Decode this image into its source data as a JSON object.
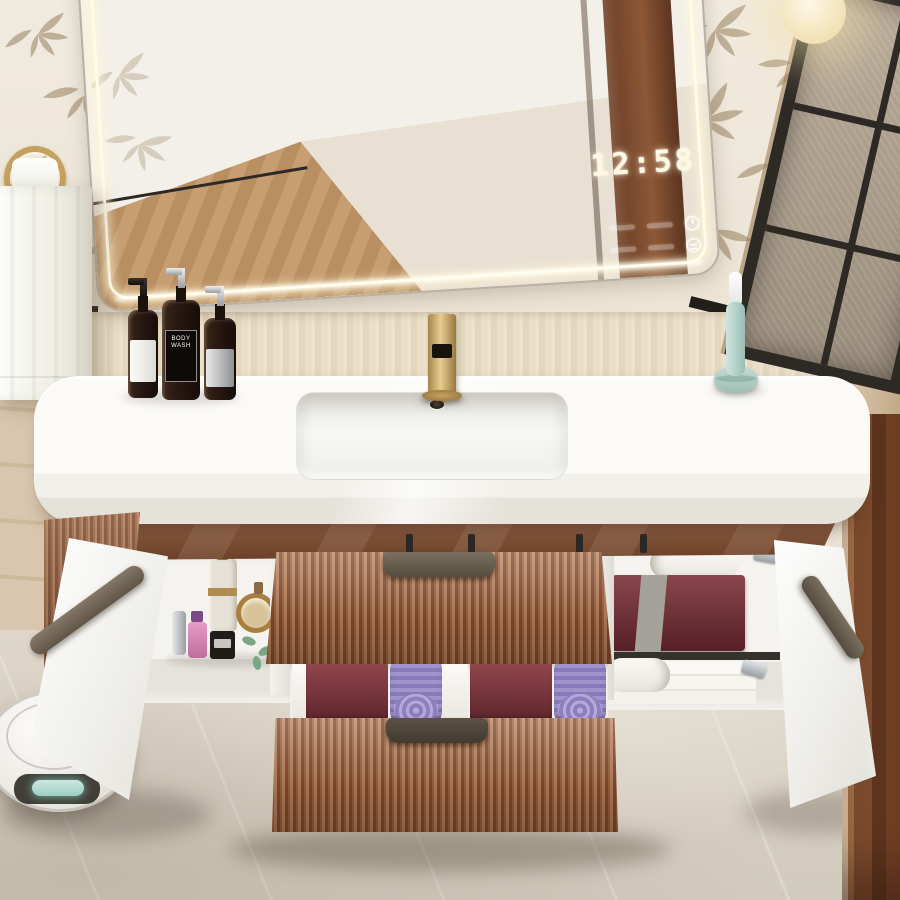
{
  "photo": {
    "description": "Bathroom vanity with backlit LED mirror and digital clock, gold faucet, amber soap bottles, mint electric toothbrush, open fluted walnut drawers with rolled towels, open side cabinets with perfumes and towels, robot vacuum on the floor",
    "mirror": {
      "clock_time": "12:58",
      "icons": [
        "power-icon",
        "defog-icon"
      ],
      "touch_label_slots": 4
    },
    "counter": {
      "bottle_count": 3,
      "body_wash_label": "BODY WASH"
    },
    "lower_drawer": {
      "purple_towel_rolls": 2,
      "burgundy_towels": 2,
      "white_towels": 4
    },
    "right_cabinet": {
      "burgundy_towels": 1,
      "white_rolled_towels": 2,
      "white_folded_towels": 3
    },
    "left_cabinet": {
      "perfume_bottles": 5
    },
    "colors": {
      "wall_cream": "#ece5d6",
      "backsplash_beige": "#e8ddc6",
      "stone_wall": "#d6c3a9",
      "floor_marble": "#d7d0c3",
      "fluted_wood": "#a96f4d",
      "apron_brown": "#7c4e32",
      "bronze_handle": "#5f5548",
      "gold_faucet": "#c8a567",
      "led_glow": "#fff4d4",
      "toothbrush_mint": "#bcd8d0",
      "towel_purple": "#988bc4",
      "towel_burgundy": "#7a383d",
      "robot_display_teal": "#bfe0d8",
      "door_wood": "#7c4a2c",
      "window_frame": "#2d2925",
      "trim_black": "#221e19"
    }
  }
}
